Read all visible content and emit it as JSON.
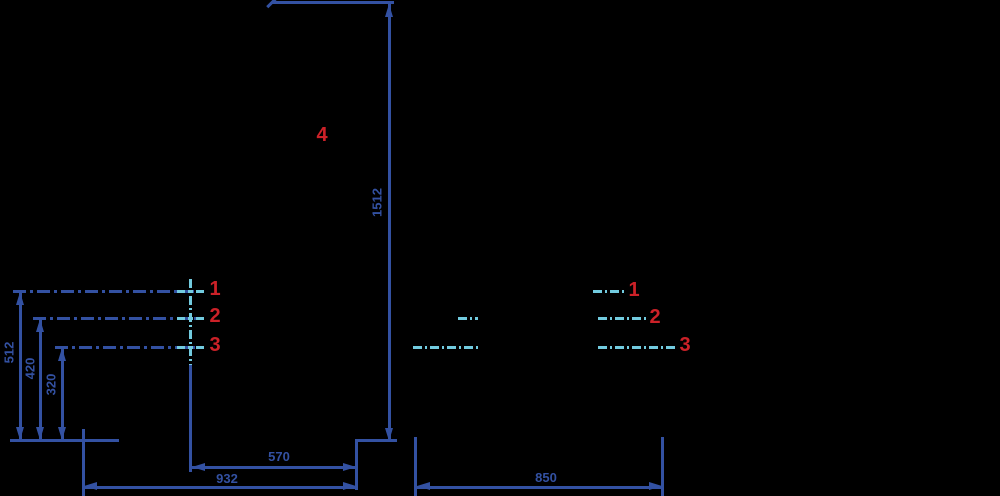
{
  "drawing_type": "installation-dimension-drawing",
  "colors": {
    "background": "#000000",
    "line_blue": "#3351a2",
    "centerline_cyan": "#72cbdf",
    "label_red": "#cc2128"
  },
  "dims": {
    "overall_height": "1512",
    "height_1": "512",
    "height_2": "420",
    "height_3": "320",
    "bottom_left_overall": "932",
    "bottom_left_inner": "570",
    "bottom_right": "850"
  },
  "markers": {
    "left": [
      "1",
      "2",
      "3"
    ],
    "right": [
      "1",
      "2",
      "3"
    ],
    "part": "4"
  }
}
